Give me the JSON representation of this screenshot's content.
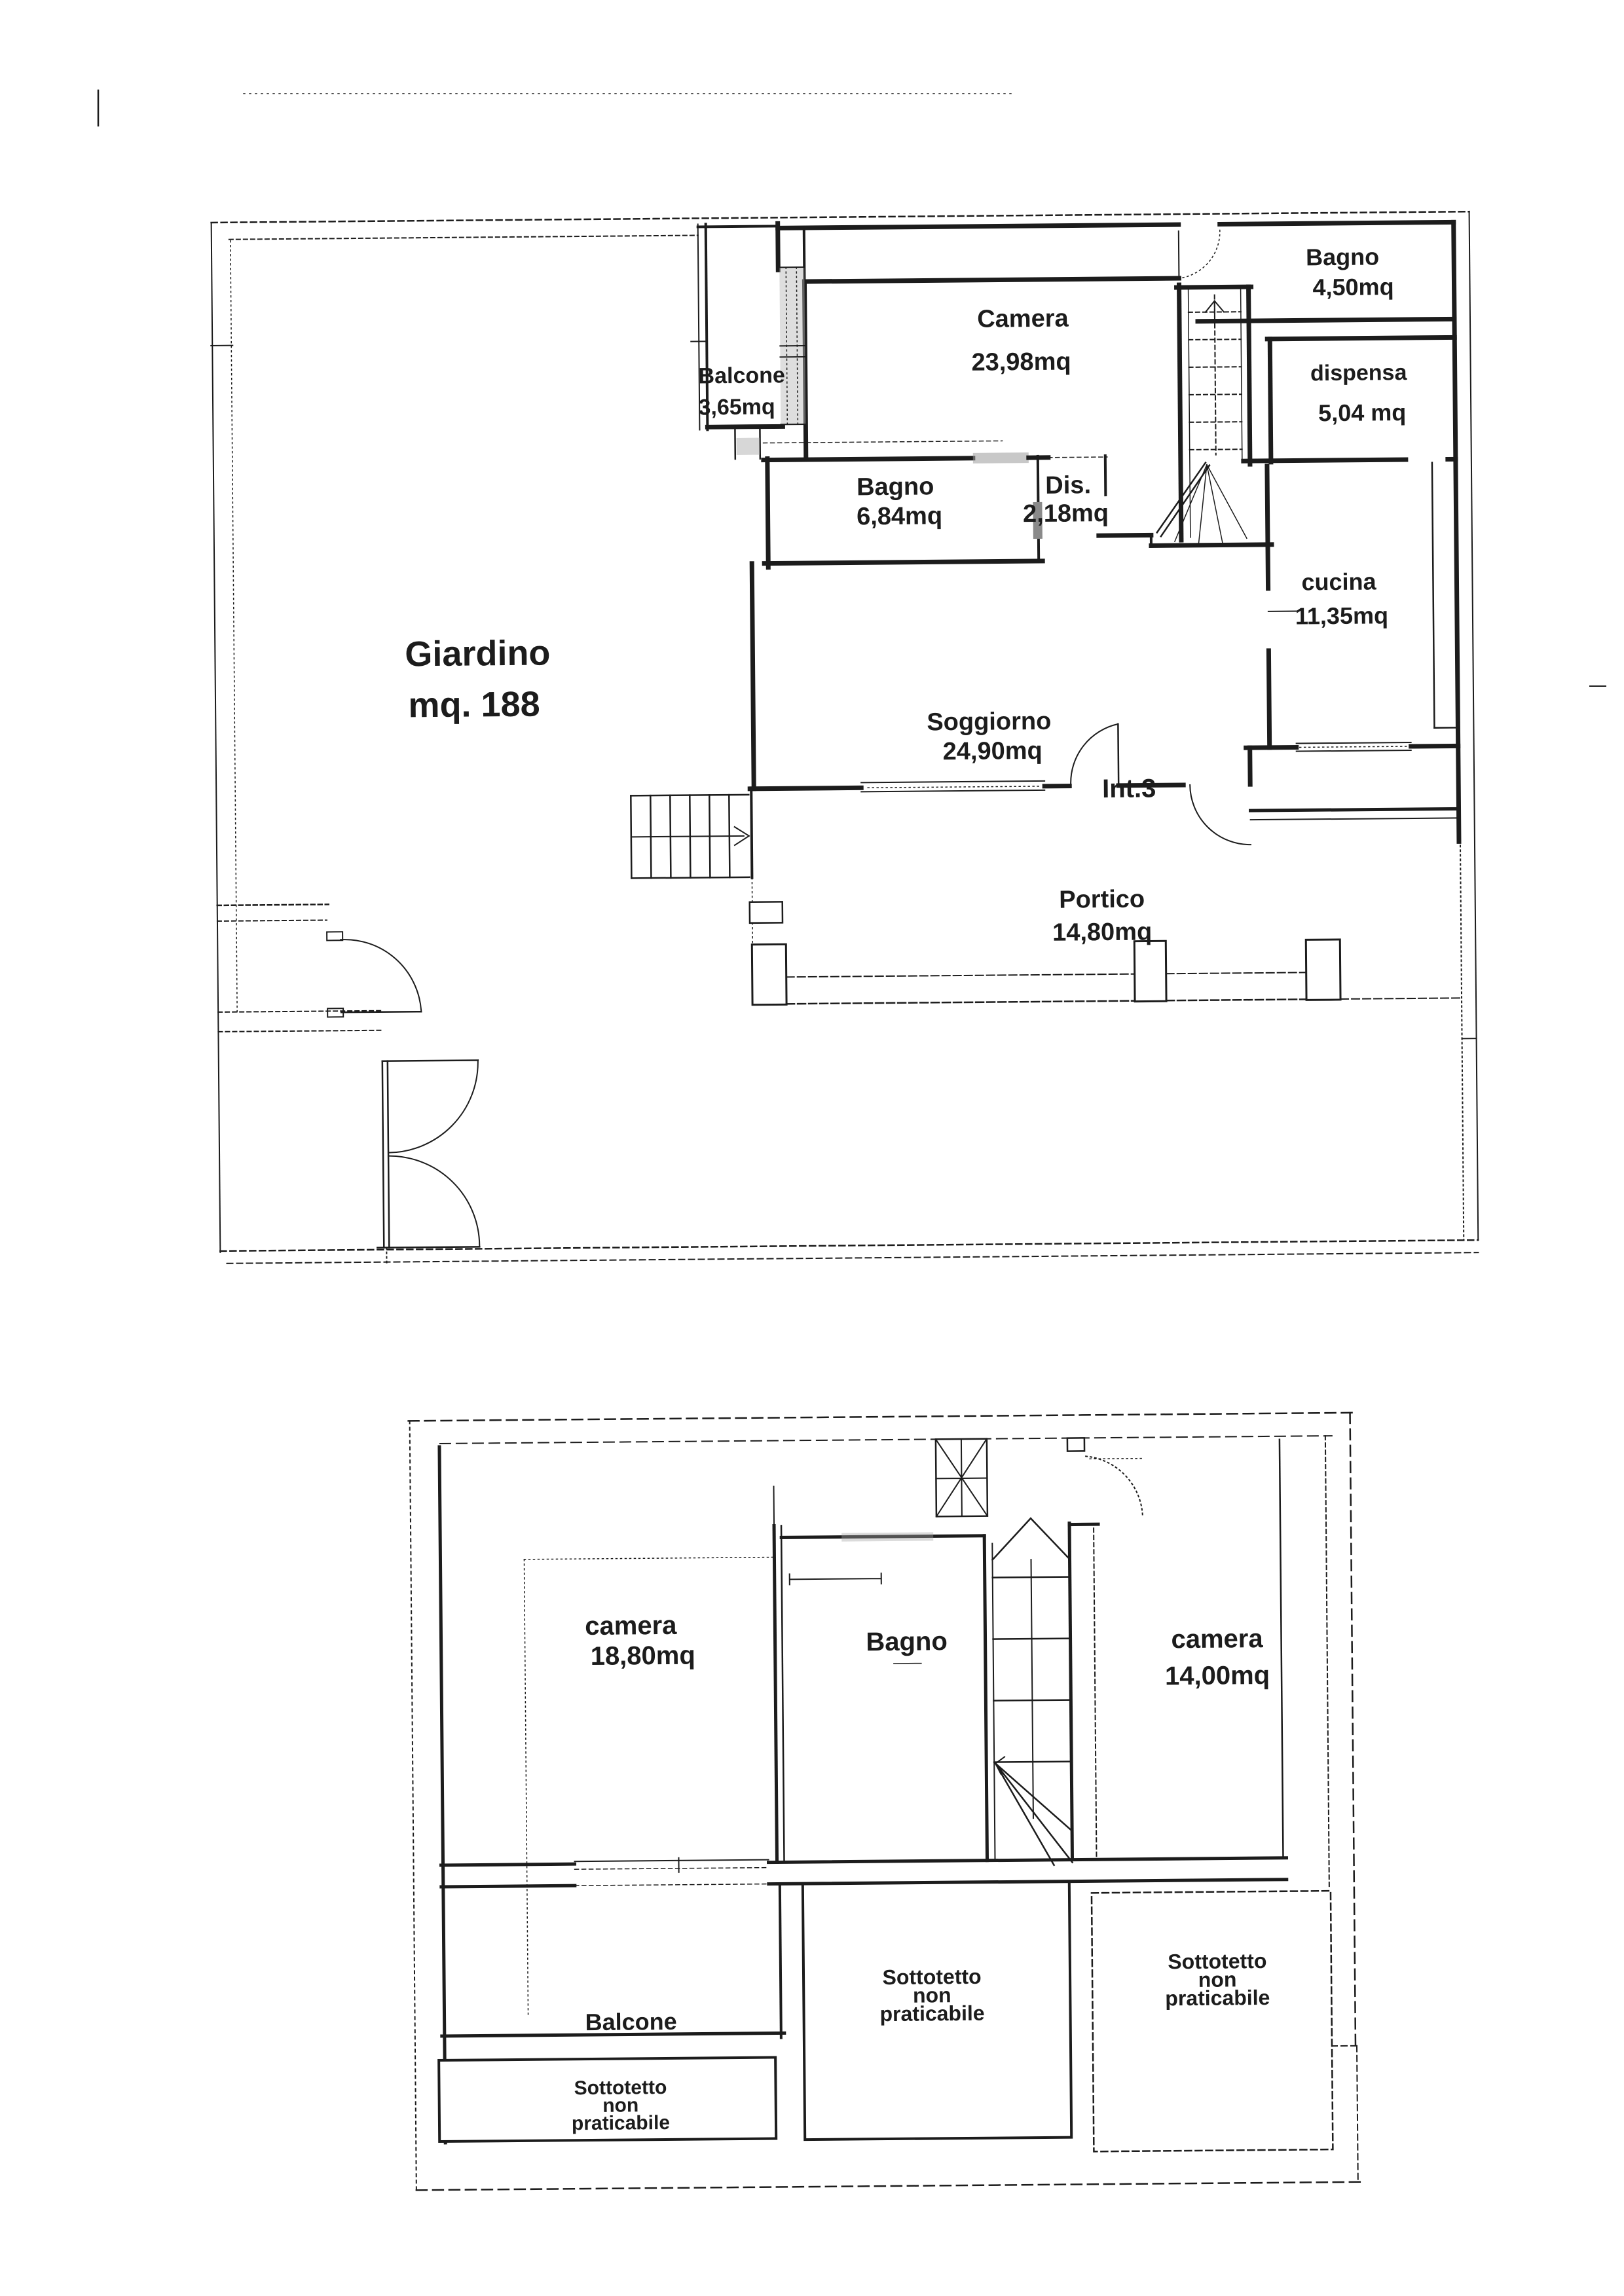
{
  "ink": "#1c1c1c",
  "ground_floor": {
    "giardino_name": "Giardino",
    "giardino_area": "mq. 188",
    "balcone_name": "Balcone",
    "balcone_area": "3,65mq",
    "camera_name": "Camera",
    "camera_area": "23,98mq",
    "bagno_nord_name": "Bagno",
    "bagno_nord_area": "4,50mq",
    "dispensa_name": "dispensa",
    "dispensa_area": "5,04 mq",
    "bagno_name": "Bagno",
    "bagno_area": "6,84mq",
    "dis_name": "Dis.",
    "dis_area": "2,18mq",
    "cucina_name": "cucina",
    "cucina_area": "11,35mq",
    "soggiorno_name": "Soggiorno",
    "soggiorno_area": "24,90mq",
    "int_label": "Int.3",
    "portico_name": "Portico",
    "portico_area": "14,80mq"
  },
  "attic_floor": {
    "camera_left_name": "camera",
    "camera_left_area": "18,80mq",
    "bagno_name": "Bagno",
    "camera_right_name": "camera",
    "camera_right_area": "14,00mq",
    "balcone_name": "Balcone",
    "sottotetto": [
      "Sottotetto",
      "non",
      "praticabile"
    ]
  }
}
